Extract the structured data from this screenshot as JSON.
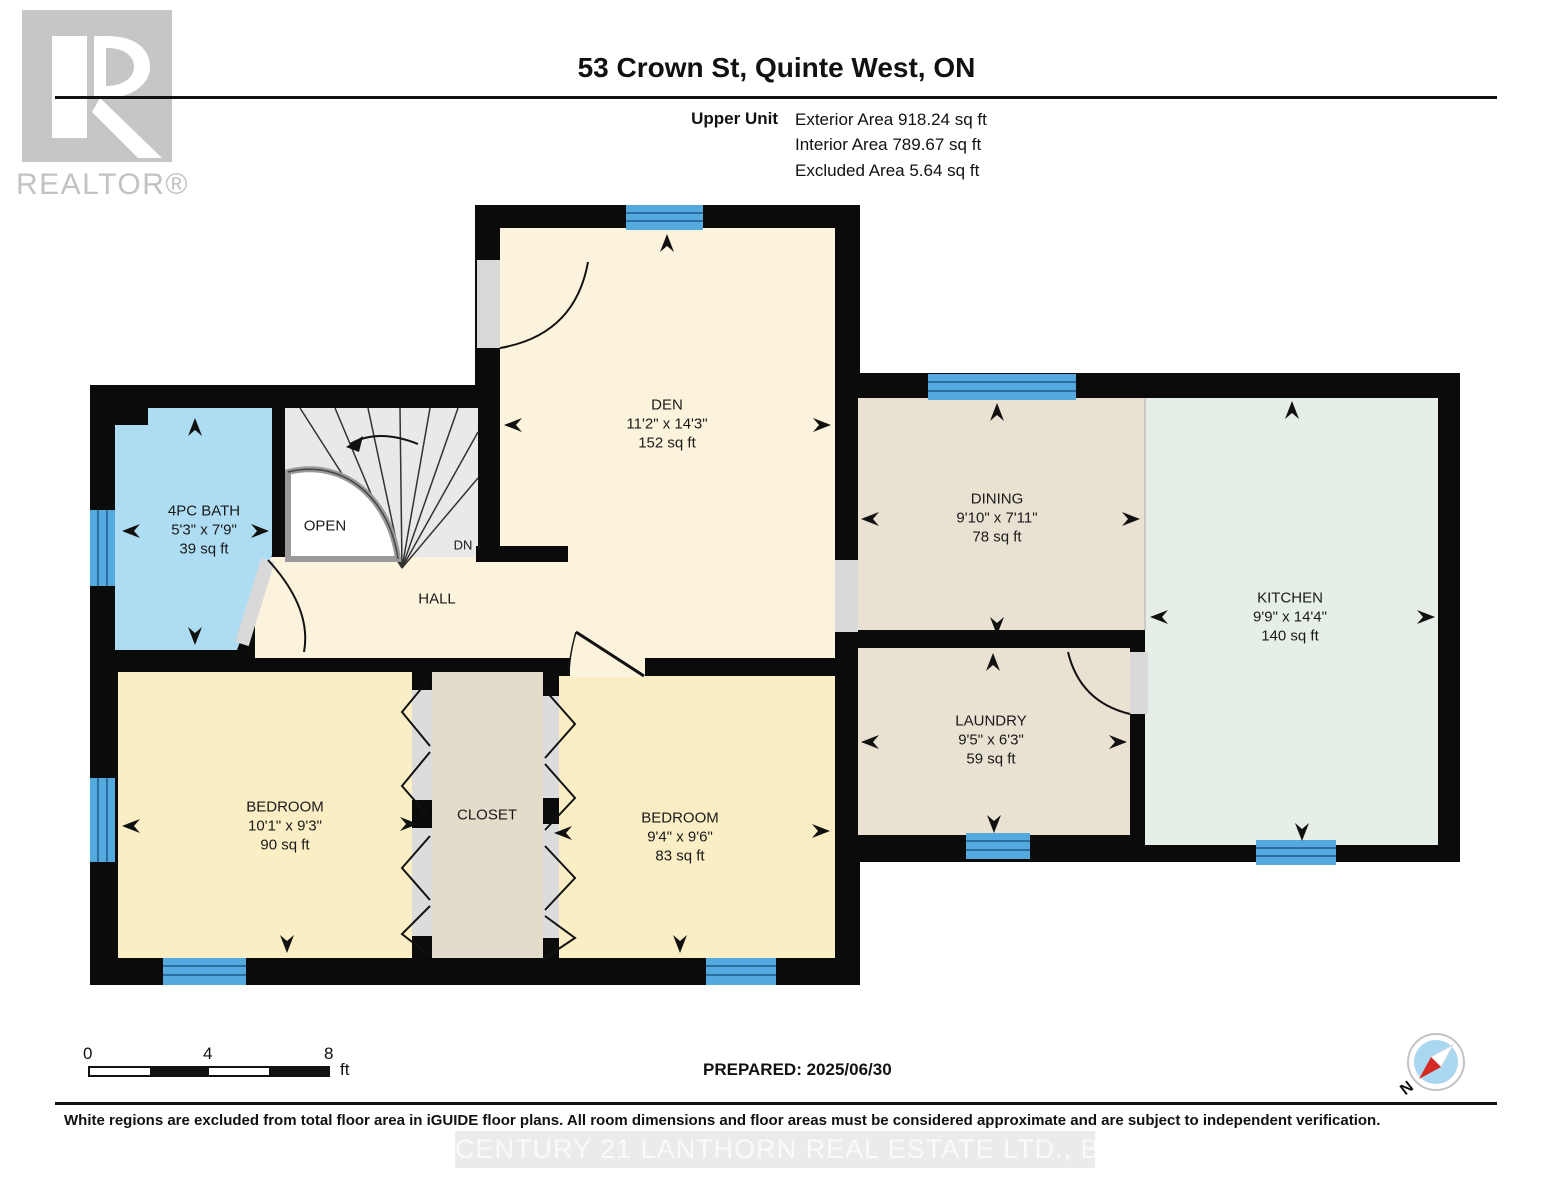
{
  "header": {
    "title": "53 Crown St, Quinte West, ON",
    "unit_label": "Upper Unit",
    "exterior": "Exterior Area 918.24 sq ft",
    "interior": "Interior Area 789.67 sq ft",
    "excluded": "Excluded Area 5.64 sq ft"
  },
  "logo": {
    "realtor": "REALTOR®"
  },
  "rooms": {
    "den": {
      "name": "DEN",
      "dims": "11'2\" x 14'3\"",
      "area": "152 sq ft"
    },
    "dining": {
      "name": "DINING",
      "dims": "9'10\" x 7'11\"",
      "area": "78 sq ft"
    },
    "kitchen": {
      "name": "KITCHEN",
      "dims": "9'9\" x 14'4\"",
      "area": "140 sq ft"
    },
    "laundry": {
      "name": "LAUNDRY",
      "dims": "9'5\" x 6'3\"",
      "area": "59 sq ft"
    },
    "bath": {
      "name": "4PC BATH",
      "dims": "5'3\" x 7'9\"",
      "area": "39 sq ft"
    },
    "bedroom_left": {
      "name": "BEDROOM",
      "dims": "10'1\" x 9'3\"",
      "area": "90 sq ft"
    },
    "bedroom_right": {
      "name": "BEDROOM",
      "dims": "9'4\" x 9'6\"",
      "area": "83 sq ft"
    },
    "closet": {
      "name": "CLOSET"
    },
    "hall": {
      "name": "HALL"
    },
    "open": {
      "name": "OPEN"
    },
    "dn": {
      "name": "DN"
    }
  },
  "scale_bar": {
    "start": "0",
    "mid": "4",
    "end": "8",
    "unit": "ft"
  },
  "prepared": "PREPARED: 2025/06/30",
  "compass": {
    "north": "N"
  },
  "footer": {
    "disclaimer": "White regions are excluded from total floor area in iGUIDE floor plans. All room dimensions and floor areas must be considered approximate and are subject to independent verification.",
    "watermark": "CENTURY 21 LANTHORN REAL ESTATE LTD., Brokerage"
  },
  "colors": {
    "wall": "#0b0b0b",
    "den": "#fbf3dc",
    "hall": "#fbf3dc",
    "bedroom": "#fbeec5",
    "dining": "#e9e2d3",
    "laundry": "#e9e2d3",
    "closet": "#e3dccb",
    "kitchen": "#e6efe7",
    "bath": "#aeddf3",
    "window": "#54a9de",
    "window_line": "#2a6d9e",
    "door_gray": "#d9d9d9",
    "stair": "#e9e9e9",
    "compass_blue": "#a9d7f2",
    "compass_red": "#d42a22"
  }
}
